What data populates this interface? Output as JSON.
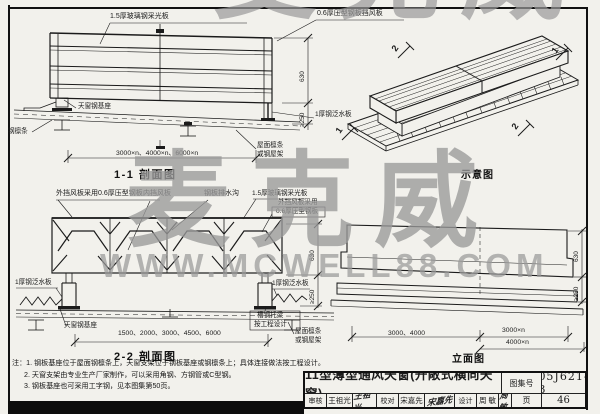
{
  "watermark": {
    "brand": "麦克威",
    "site": "WWW.MCWELL88.COM"
  },
  "fig_1_1": {
    "title": "1-1 剖面图",
    "label_panel": "1.5厚玻璃钢采光板",
    "label_windboard": "0.6厚压型钢板挡风板",
    "label_base": "天窗钢基座",
    "label_purlin": "钢檩条",
    "label_flashing": "1厚钢泛水板",
    "label_roof_l1": "屋面檩条",
    "label_roof_l2": "或钢屋架",
    "dim_span": "3000×n、4000×n、6000×n",
    "dim_h1": "630",
    "dim_h2": "≥250"
  },
  "fig_iso": {
    "title": "示意图",
    "mark_tl": "2",
    "mark_tr": "1",
    "mark_bl": "1",
    "mark_br": "2"
  },
  "fig_2_2": {
    "title": "2-2 剖面图",
    "label_outer": "外挡风板采用0.6厚压型钢板",
    "label_inner": "内挡风板",
    "label_gutter": "钢板排水沟",
    "label_panel": "1.5厚玻璃钢采光板",
    "label_outer2_l1": "外挡风板采用",
    "label_outer2_l2": "0.6厚压型钢板",
    "label_flash_left": "1厚钢泛水板",
    "label_flash_right": "1厚钢泛水板",
    "label_base": "天窗钢基座",
    "label_joist_l1": "槽钢托梁",
    "label_joist_l2": "按工程设计",
    "label_roof_l1": "屋面檩条",
    "label_roof_l2": "或钢屋架",
    "dim_span": "1500、2000、3000、4500、6000",
    "dim_h1": "630",
    "dim_h2": "≥250"
  },
  "fig_elev": {
    "title": "立面图",
    "dim_span1": "3000、4000",
    "dim_span2": "3000×n",
    "dim_span3": "4000×n",
    "dim_h1": "630",
    "dim_h2": "≥250"
  },
  "notes": {
    "l1": "注：1. 钢板基座位于屋面钢檩条上，天窗支架位于钢板基座或钢檩条上；具体连接做法按工程设计。",
    "l2": "2. 天窗支架由专业生产厂家制作，可以采用角钢、方钢管或C型钢。",
    "l3": "3. 钢板基座也可采用工字钢，见本图集第50页。"
  },
  "titleblock": {
    "title": "11型薄型通风天窗(开敞式横向天窗)",
    "atlas_label": "图集号",
    "atlas_no": "05J621-3",
    "page_label": "页",
    "page_no": "46",
    "review_label": "审核",
    "review_name": "王祖光",
    "review_sig": "王祖光",
    "check_label": "校对",
    "check_name": "宋嘉先",
    "check_sig": "宋嘉先",
    "design_label": "设计",
    "design_name": "周 敏",
    "design_sig": "周敏"
  }
}
